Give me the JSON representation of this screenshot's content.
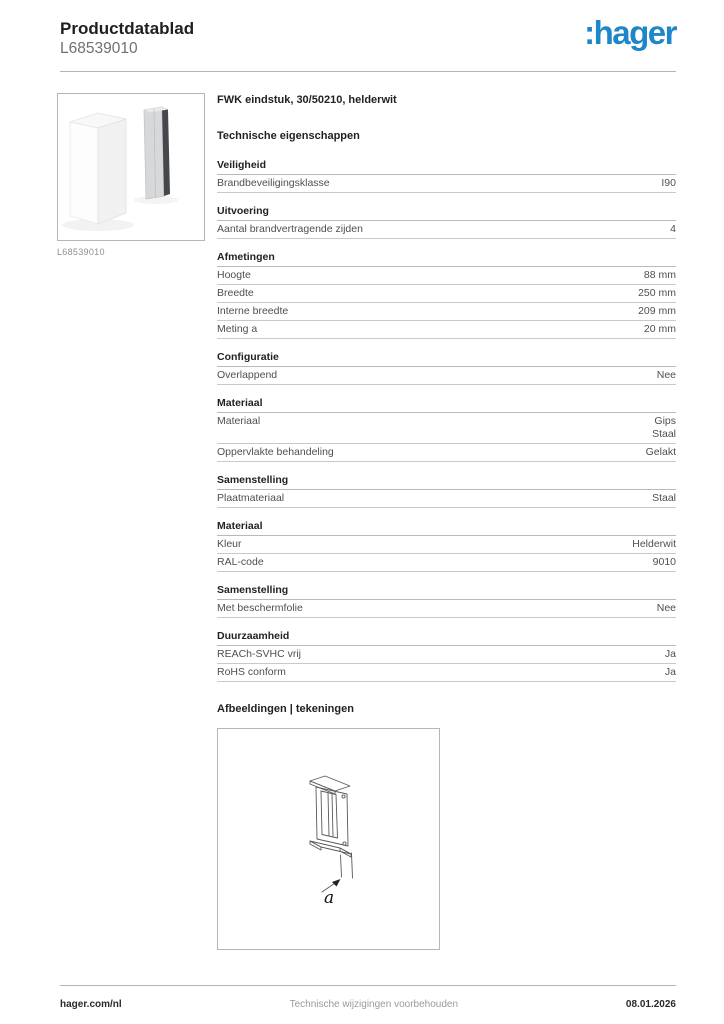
{
  "brand": {
    "logo_text": ":hager",
    "logo_color": "#1d87c9"
  },
  "header": {
    "title": "Productdatablad",
    "code": "L68539010"
  },
  "product": {
    "title": "FWK eindstuk, 30/50210, helderwit",
    "image_caption": "L68539010"
  },
  "specs": {
    "heading": "Technische eigenschappen",
    "sections": [
      {
        "title": "Veiligheid",
        "rows": [
          {
            "label": "Brandbeveiligingsklasse",
            "values": [
              "I90"
            ]
          }
        ]
      },
      {
        "title": "Uitvoering",
        "rows": [
          {
            "label": "Aantal brandvertragende zijden",
            "values": [
              "4"
            ]
          }
        ]
      },
      {
        "title": "Afmetingen",
        "rows": [
          {
            "label": "Hoogte",
            "values": [
              "88 mm"
            ]
          },
          {
            "label": "Breedte",
            "values": [
              "250 mm"
            ]
          },
          {
            "label": "Interne breedte",
            "values": [
              "209 mm"
            ]
          },
          {
            "label": "Meting a",
            "values": [
              "20 mm"
            ]
          }
        ]
      },
      {
        "title": "Configuratie",
        "rows": [
          {
            "label": "Overlappend",
            "values": [
              "Nee"
            ]
          }
        ]
      },
      {
        "title": "Materiaal",
        "rows": [
          {
            "label": "Materiaal",
            "values": [
              "Gips",
              "Staal"
            ]
          },
          {
            "label": "Oppervlakte behandeling",
            "values": [
              "Gelakt"
            ]
          }
        ]
      },
      {
        "title": "Samenstelling",
        "rows": [
          {
            "label": "Plaatmateriaal",
            "values": [
              "Staal"
            ]
          }
        ]
      },
      {
        "title": "Materiaal",
        "rows": [
          {
            "label": "Kleur",
            "values": [
              "Helderwit"
            ]
          },
          {
            "label": "RAL-code",
            "values": [
              "9010"
            ]
          }
        ]
      },
      {
        "title": "Samenstelling",
        "rows": [
          {
            "label": "Met beschermfolie",
            "values": [
              "Nee"
            ]
          }
        ]
      },
      {
        "title": "Duurzaamheid",
        "rows": [
          {
            "label": "REACh-SVHC vrij",
            "values": [
              "Ja"
            ]
          },
          {
            "label": "RoHS conform",
            "values": [
              "Ja"
            ]
          }
        ]
      }
    ]
  },
  "images_section": {
    "heading": "Afbeeldingen | tekeningen",
    "drawing_label": "a"
  },
  "footer": {
    "left": "hager.com/nl",
    "center": "Technische wijzigingen voorbehouden",
    "right": "08.01.2026"
  }
}
